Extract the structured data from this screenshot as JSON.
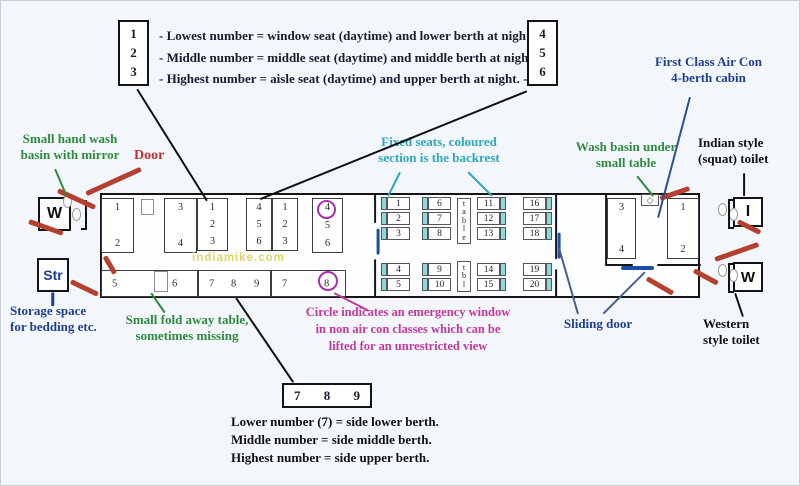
{
  "watermark": "indiamike.com",
  "legend_top": {
    "box_left": [
      "1",
      "2",
      "3"
    ],
    "box_right": [
      "4",
      "5",
      "6"
    ],
    "lines": [
      "- Lowest number = window seat (daytime) and lower berth at night. -",
      "- Middle number = middle seat (daytime) and middle berth at night. -",
      "- Highest number = aisle seat (daytime) and upper berth at night. -"
    ]
  },
  "legend_bottom": {
    "box": [
      "7",
      "8",
      "9"
    ],
    "lines": [
      "Lower number (7) = side lower berth.",
      "Middle number = side middle berth.",
      "Highest number = side upper berth."
    ]
  },
  "labels": {
    "small_wash": [
      "Small hand wash",
      "basin with mirror"
    ],
    "door": [
      "Door"
    ],
    "fixed_seats": [
      "Fixed seats, coloured",
      "section is the backrest"
    ],
    "wash_basin": [
      "Wash basin under",
      "small table"
    ],
    "first_class": [
      "First Class Air Con",
      "4-berth cabin"
    ],
    "indian_toilet": [
      "Indian style",
      "(squat) toilet"
    ],
    "western_toilet": [
      "Western",
      "style toilet"
    ],
    "sliding_door": [
      "Sliding door"
    ],
    "storage": [
      "Storage space",
      "for bedding etc."
    ],
    "fold_table": [
      "Small fold away table,",
      "sometimes missing"
    ],
    "emergency": [
      "Circle indicates an emergency window",
      "in non air con classes which can be",
      "lifted for an unrestricted view"
    ]
  },
  "colors": {
    "green": "#2e8b3c",
    "red_door": "#b5402f",
    "red_label": "#c03030",
    "teal": "#2da7bd",
    "navy": "#1e3f8f",
    "slate_line": "#45608c",
    "magenta": "#c03a9c",
    "purple_circle": "#aa2fae",
    "seat_cyan": "#8adadd",
    "blue_slider": "#1d4ea5",
    "watermark": "#e3d35f",
    "background": "#f3f7fc"
  },
  "coach": {
    "end_boxes": [
      {
        "name": "toilet-wash-left",
        "label": "W",
        "x": 37,
        "y": 196,
        "w": 33,
        "h": 34,
        "c": "#111111",
        "fs": 16
      },
      {
        "name": "storage-box",
        "label": "Str",
        "x": 36,
        "y": 257,
        "w": 32,
        "h": 34,
        "c": "#1e3f8f",
        "fs": 14
      },
      {
        "name": "toilet-indian-right",
        "label": "I",
        "x": 732,
        "y": 196,
        "w": 30,
        "h": 30,
        "c": "#111111",
        "fs": 16
      },
      {
        "name": "toilet-western-right",
        "label": "W",
        "x": 732,
        "y": 261,
        "w": 30,
        "h": 30,
        "c": "#111111",
        "fs": 15
      }
    ],
    "berth_boxes": [
      {
        "type": "v2",
        "x": 100,
        "y": 197,
        "w": 33,
        "h": 55,
        "nums": [
          "1",
          "2"
        ]
      },
      {
        "type": "v2",
        "x": 163,
        "y": 197,
        "w": 33,
        "h": 55,
        "nums": [
          "3",
          "4"
        ]
      },
      {
        "type": "v3",
        "x": 196,
        "y": 197,
        "w": 31,
        "h": 53,
        "nums": [
          "1",
          "2",
          "3"
        ]
      },
      {
        "type": "v3",
        "x": 245,
        "y": 197,
        "w": 26,
        "h": 53,
        "nums": [
          "4",
          "5",
          "6"
        ]
      },
      {
        "type": "v3",
        "x": 271,
        "y": 197,
        "w": 26,
        "h": 53,
        "nums": [
          "1",
          "2",
          "3"
        ]
      },
      {
        "type": "v3",
        "x": 311,
        "y": 197,
        "w": 31,
        "h": 55,
        "nums": [
          "4",
          "5",
          "6"
        ]
      },
      {
        "type": "v2",
        "x": 606,
        "y": 197,
        "w": 29,
        "h": 61,
        "nums": [
          "3",
          "4"
        ]
      },
      {
        "type": "v2",
        "x": 666,
        "y": 197,
        "w": 32,
        "h": 61,
        "nums": [
          "1",
          "2"
        ]
      },
      {
        "type": "h",
        "x": 100,
        "y": 269,
        "w": 97,
        "h": 27,
        "nums": [
          "5",
          "6"
        ],
        "spread": [
          10,
          70
        ]
      },
      {
        "type": "h",
        "x": 197,
        "y": 269,
        "w": 73,
        "h": 27,
        "nums": [
          "7",
          "8",
          "9"
        ],
        "spread": [
          10,
          32,
          55
        ]
      },
      {
        "type": "h",
        "x": 270,
        "y": 269,
        "w": 75,
        "h": 27,
        "nums": [
          "7",
          "8"
        ],
        "spread": [
          10,
          52
        ]
      }
    ],
    "fold_squares": [
      {
        "x": 140,
        "y": 198,
        "w": 13,
        "h": 16
      },
      {
        "x": 153,
        "y": 270,
        "w": 14,
        "h": 21
      }
    ],
    "chair_cols": [
      {
        "x": 380,
        "y": 196,
        "strip": "left",
        "nums": [
          "1",
          "2",
          "3"
        ]
      },
      {
        "x": 421,
        "y": 196,
        "strip": "left",
        "nums": [
          "6",
          "7",
          "8"
        ]
      },
      {
        "x": 476,
        "y": 196,
        "strip": "right",
        "nums": [
          "11",
          "12",
          "13"
        ]
      },
      {
        "x": 522,
        "y": 196,
        "strip": "right",
        "nums": [
          "16",
          "17",
          "18"
        ]
      },
      {
        "x": 380,
        "y": 262,
        "strip": "left",
        "nums": [
          "4",
          "5"
        ]
      },
      {
        "x": 421,
        "y": 262,
        "strip": "left",
        "nums": [
          "9",
          "10"
        ]
      },
      {
        "x": 476,
        "y": 262,
        "strip": "right",
        "nums": [
          "14",
          "15"
        ]
      },
      {
        "x": 522,
        "y": 262,
        "strip": "right",
        "nums": [
          "19",
          "20"
        ]
      }
    ],
    "tables": [
      {
        "x": 456,
        "y": 197,
        "w": 14,
        "h": 46,
        "text": "table"
      },
      {
        "x": 456,
        "y": 260,
        "w": 14,
        "h": 31,
        "text": "tbl"
      }
    ],
    "basin": {
      "x": 640,
      "y": 193,
      "w": 18,
      "h": 12,
      "glyph": "◇"
    },
    "walls": [
      [
        374,
        192,
        374,
        222
      ],
      [
        374,
        258,
        374,
        296
      ],
      [
        555,
        192,
        555,
        258
      ],
      [
        555,
        268,
        555,
        296
      ],
      [
        605,
        192,
        605,
        265
      ],
      [
        605,
        264,
        632,
        264
      ],
      [
        656,
        264,
        700,
        264
      ]
    ],
    "blue_markers": [
      [
        377,
        228,
        377,
        254
      ],
      [
        558,
        232,
        558,
        258
      ],
      [
        620,
        267,
        653,
        267
      ]
    ],
    "circles": [
      {
        "x": 316,
        "y": 199,
        "d": 19,
        "num_ref": "4"
      },
      {
        "x": 317,
        "y": 270,
        "d": 20,
        "num_ref": "8"
      }
    ],
    "door_dashes": [
      [
        57,
        189,
        94,
        206
      ],
      [
        28,
        220,
        62,
        232
      ],
      [
        104,
        255,
        114,
        272
      ],
      [
        70,
        280,
        97,
        293
      ],
      [
        140,
        168,
        85,
        193
      ],
      [
        659,
        197,
        688,
        187
      ],
      [
        737,
        220,
        759,
        231
      ],
      [
        714,
        258,
        757,
        243
      ],
      [
        693,
        269,
        717,
        282
      ],
      [
        646,
        277,
        672,
        292
      ]
    ],
    "ovals": [
      [
        62,
        194
      ],
      [
        71,
        207
      ],
      [
        717,
        202
      ],
      [
        728,
        207
      ],
      [
        717,
        263
      ],
      [
        728,
        268
      ]
    ],
    "brackets": [
      {
        "x": 80,
        "y": 199,
        "h": 30,
        "open": "left"
      },
      {
        "x": 727,
        "y": 198,
        "h": 30,
        "open": "right"
      },
      {
        "x": 727,
        "y": 262,
        "h": 30,
        "open": "right"
      }
    ]
  },
  "pointer_lines": [
    {
      "pts": [
        54,
        168,
        66,
        196
      ],
      "c": "#2e8b3c",
      "w": 2.2,
      "name": "line-to-hand-wash-basin"
    },
    {
      "pts": [
        150,
        292,
        164,
        312
      ],
      "c": "#2e8b3c",
      "w": 2.2,
      "name": "line-to-fold-table"
    },
    {
      "pts": [
        636,
        175,
        652,
        195
      ],
      "c": "#2e8b3c",
      "w": 2.2,
      "name": "line-to-wash-basin"
    },
    {
      "pts": [
        399,
        171,
        387,
        195
      ],
      "c": "#2da7bd",
      "w": 2.2,
      "name": "line-to-fixed-seat-1"
    },
    {
      "pts": [
        467,
        171,
        491,
        195
      ],
      "c": "#2da7bd",
      "w": 2.2,
      "name": "line-to-fixed-seat-2"
    },
    {
      "pts": [
        52,
        291,
        52,
        305
      ],
      "c": "#1e3f8f",
      "w": 2.5,
      "name": "line-to-storage"
    },
    {
      "pts": [
        558,
        247,
        577,
        313
      ],
      "c": "#45608c",
      "w": 2,
      "name": "line-to-sliding-door-1"
    },
    {
      "pts": [
        644,
        271,
        602,
        313
      ],
      "c": "#45608c",
      "w": 2,
      "name": "line-to-sliding-door-2"
    },
    {
      "pts": [
        689,
        96,
        657,
        217
      ],
      "c": "#2e4f94",
      "w": 2,
      "name": "line-to-first-class-cabin"
    },
    {
      "pts": [
        743,
        172,
        743,
        195
      ],
      "c": "#111111",
      "w": 2.2,
      "name": "line-to-indian-toilet"
    },
    {
      "pts": [
        734,
        292,
        742,
        316
      ],
      "c": "#111111",
      "w": 2.2,
      "name": "line-to-western-toilet"
    },
    {
      "pts": [
        235,
        297,
        292,
        381
      ],
      "c": "#111111",
      "w": 2.2,
      "name": "line-to-side-berth-legend"
    },
    {
      "pts": [
        136,
        88,
        206,
        200
      ],
      "c": "#111111",
      "w": 2.2,
      "name": "line-from-legend-123"
    },
    {
      "pts": [
        526,
        90,
        259,
        198
      ],
      "c": "#111111",
      "w": 2.2,
      "name": "line-from-legend-456"
    },
    {
      "pts": [
        333,
        292,
        368,
        310
      ],
      "c": "#c03a9c",
      "w": 2.2,
      "name": "line-to-emergency-note"
    }
  ]
}
